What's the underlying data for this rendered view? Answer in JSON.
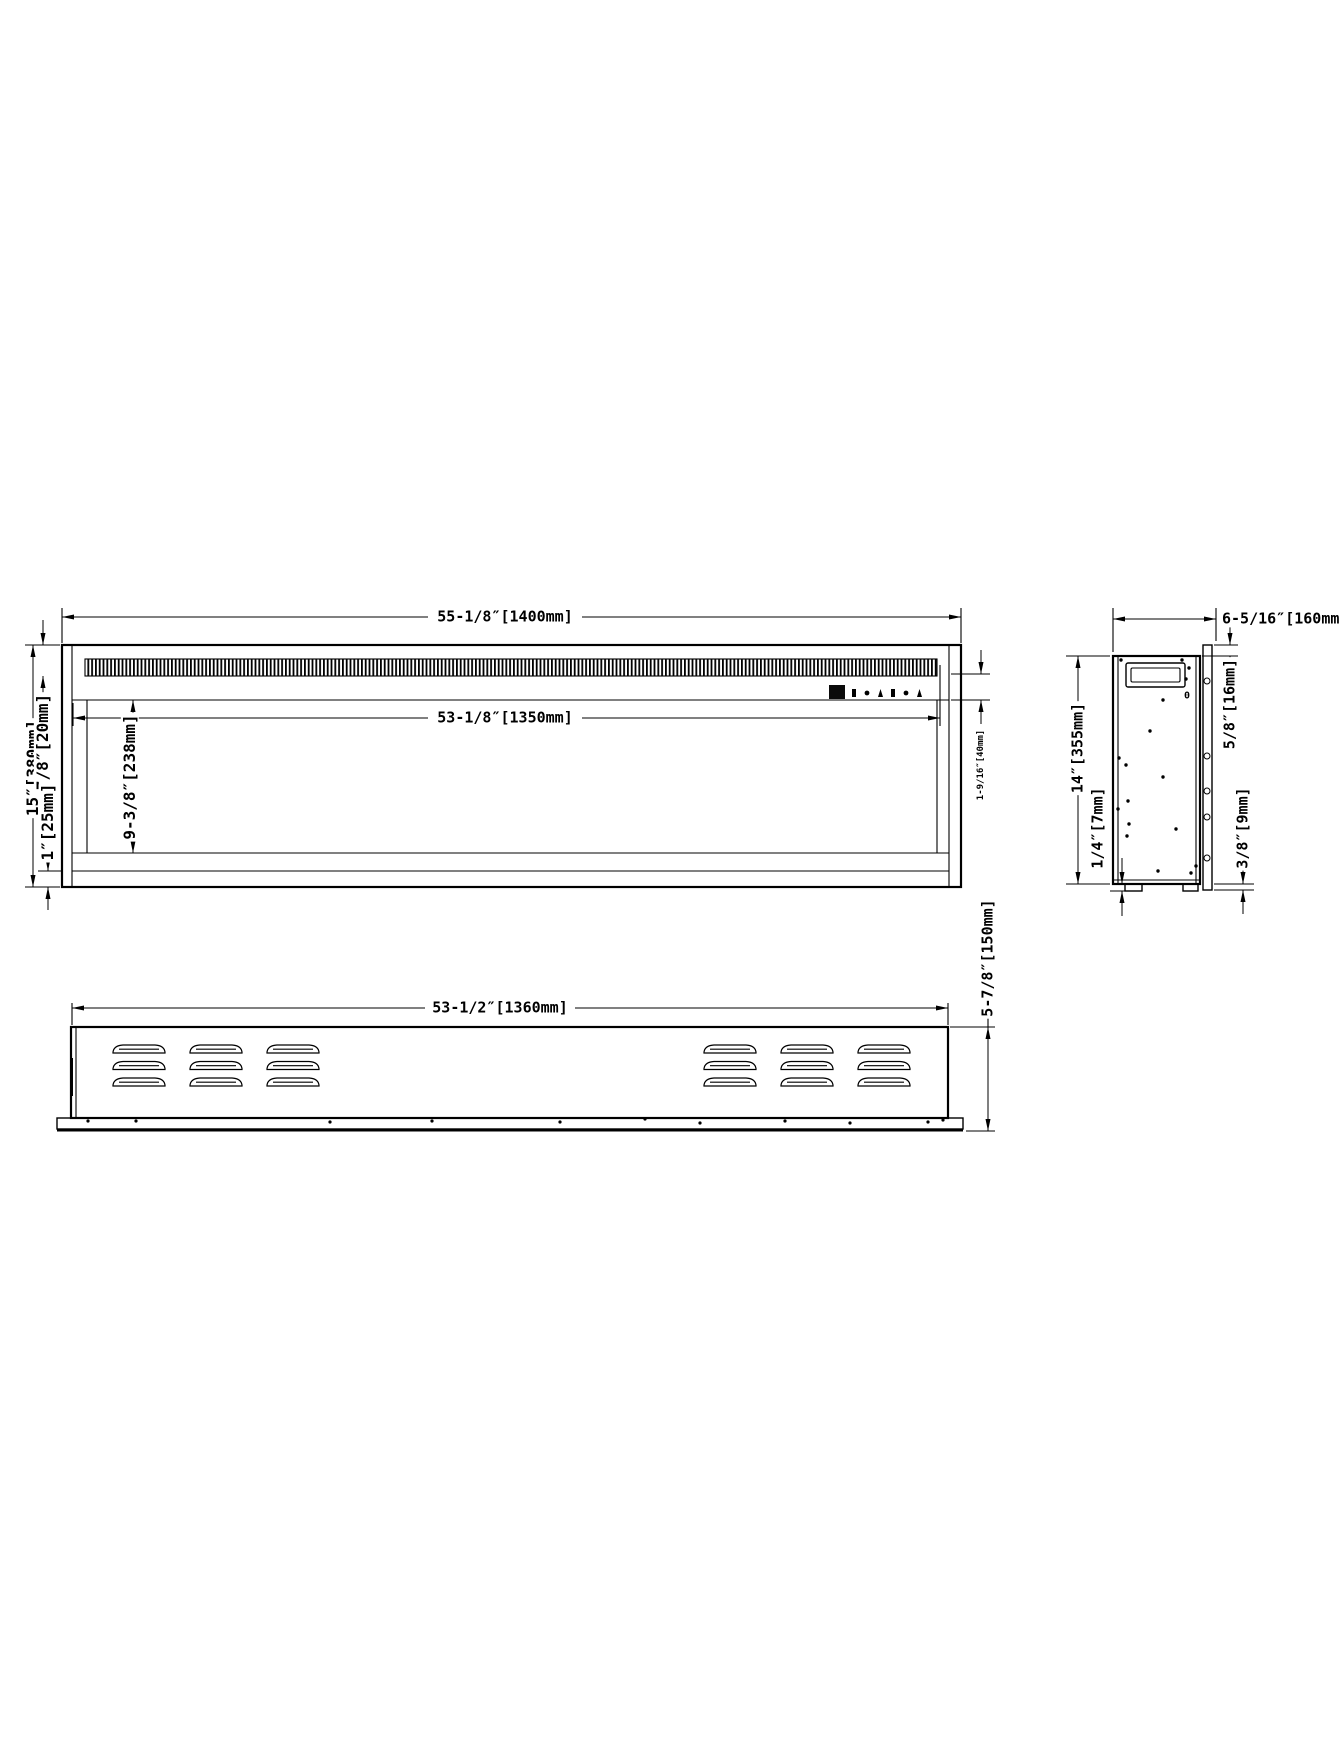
{
  "front_view": {
    "overall_width": "55-1/8″[1400mm]",
    "opening_width": "53-1/8″[1350mm]",
    "overall_height": "15″[380mm]",
    "grille_height": "7/8″[20mm]",
    "bottom_frame": "1″[25mm]",
    "opening_height": "9-3/8″[238mm]",
    "control_panel_height": "1-9/16″[40mm]"
  },
  "side_view": {
    "overall_depth": "6-5/16″[160mm]",
    "overall_height": "14″[355mm]",
    "flange_depth": "5/8″[16mm]",
    "foot_height": "1/4″[7mm]",
    "flange_overhang": "3/8″[9mm]",
    "port_marking": "0"
  },
  "bottom_view": {
    "body_width": "53-1/2″[1360mm]",
    "overall_depth": "5-7/8″[150mm]"
  }
}
